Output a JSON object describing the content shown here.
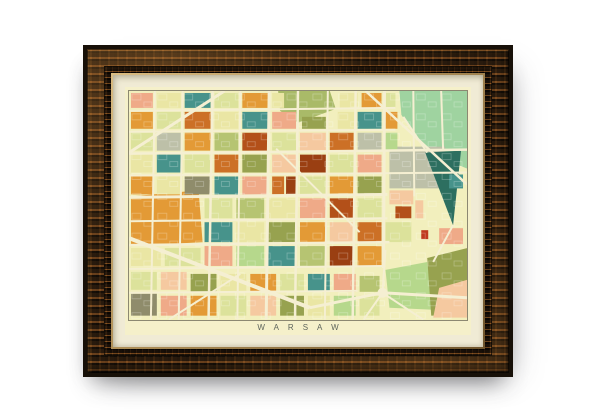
{
  "print": {
    "title": "WARSAW"
  },
  "colors": {
    "frameDark": "#171008",
    "frameMid": "#3d2a16",
    "lip": "#b3945c",
    "lipHi": "#d9bc82",
    "lipDark": "#6f552d",
    "mat": "#f0ebd5",
    "paper": "#f5f0ca",
    "rule": "#8c8872",
    "title": "#5d645c",
    "mapBase": "#f2efbd"
  },
  "map": {
    "width": 340,
    "height": 230,
    "base": "#f2efbd",
    "street_color": "#f5efd2",
    "palette": {
      "pyd": "#eae6a4",
      "yg": "#dce29b",
      "av": "#b6c472",
      "av2": "#a9ba68",
      "lg": "#b6d88c",
      "mg": "#9fd3a0",
      "ol": "#97a24f",
      "gb": "#8f8c6b",
      "te": "#47938b",
      "dt": "#2d6f60",
      "or": "#e39a36",
      "ro": "#cc7026",
      "rr": "#b35019",
      "br": "#9a3f12",
      "sa": "#efaa88",
      "pe": "#f5c9a0",
      "gr": "#bdc0a8",
      "rd": "#c03a1f"
    },
    "areas": [
      {
        "points": "272,0 340,0 340,78 300,62 274,24",
        "fill": "mg"
      },
      {
        "points": "150,0 202,0 208,18 170,32 152,20",
        "fill": "av2"
      },
      {
        "points": "262,56 318,56 318,98 262,98",
        "fill": "gr"
      },
      {
        "points": "298,62 334,60 326,135",
        "fill": "dt"
      },
      {
        "points": "2,106 70,100 74,152 2,156",
        "fill": "or"
      },
      {
        "points": "258,180 300,172 306,220 262,218",
        "fill": "lg"
      },
      {
        "points": "300,168 340,158 340,226 304,226",
        "fill": "ol"
      },
      {
        "points": "312,198 340,190 340,228 306,228",
        "fill": "pe"
      }
    ],
    "blocks": [
      [
        2,
        2,
        22,
        15,
        "sa"
      ],
      [
        28,
        2,
        24,
        15,
        "pyd"
      ],
      [
        56,
        2,
        26,
        15,
        "te"
      ],
      [
        86,
        2,
        24,
        15,
        "yg"
      ],
      [
        114,
        2,
        26,
        15,
        "or"
      ],
      [
        144,
        2,
        12,
        15,
        "pyd"
      ],
      [
        212,
        2,
        18,
        15,
        "pyd"
      ],
      [
        234,
        2,
        20,
        15,
        "or"
      ],
      [
        258,
        2,
        10,
        15,
        "yg"
      ],
      [
        2,
        21,
        22,
        17,
        "or"
      ],
      [
        28,
        21,
        24,
        17,
        "yg"
      ],
      [
        56,
        21,
        26,
        17,
        "ro"
      ],
      [
        86,
        21,
        24,
        17,
        "pyd"
      ],
      [
        114,
        21,
        26,
        17,
        "te"
      ],
      [
        144,
        21,
        24,
        17,
        "sa"
      ],
      [
        174,
        26,
        24,
        12,
        "ol"
      ],
      [
        210,
        21,
        18,
        17,
        "pyd"
      ],
      [
        230,
        21,
        24,
        17,
        "te"
      ],
      [
        258,
        21,
        12,
        17,
        "or"
      ],
      [
        2,
        42,
        22,
        18,
        "yg"
      ],
      [
        28,
        42,
        24,
        18,
        "gr"
      ],
      [
        56,
        42,
        26,
        18,
        "or"
      ],
      [
        86,
        42,
        24,
        18,
        "av"
      ],
      [
        114,
        42,
        26,
        18,
        "rr"
      ],
      [
        144,
        42,
        24,
        18,
        "yg"
      ],
      [
        172,
        42,
        26,
        18,
        "pe"
      ],
      [
        202,
        42,
        24,
        18,
        "ro"
      ],
      [
        230,
        42,
        24,
        18,
        "gr"
      ],
      [
        258,
        42,
        12,
        18,
        "lg"
      ],
      [
        2,
        64,
        22,
        18,
        "pyd"
      ],
      [
        28,
        64,
        24,
        18,
        "te"
      ],
      [
        56,
        64,
        26,
        18,
        "yg"
      ],
      [
        86,
        64,
        24,
        18,
        "ro"
      ],
      [
        114,
        64,
        26,
        18,
        "ol"
      ],
      [
        144,
        64,
        24,
        18,
        "pe"
      ],
      [
        172,
        64,
        26,
        18,
        "br"
      ],
      [
        202,
        64,
        24,
        18,
        "yg"
      ],
      [
        230,
        64,
        24,
        18,
        "sa"
      ],
      [
        322,
        84,
        14,
        14,
        "te"
      ],
      [
        2,
        86,
        22,
        18,
        "or"
      ],
      [
        28,
        86,
        24,
        18,
        "pyd"
      ],
      [
        56,
        86,
        26,
        18,
        "gb"
      ],
      [
        86,
        86,
        24,
        18,
        "te"
      ],
      [
        114,
        86,
        26,
        18,
        "sa"
      ],
      [
        144,
        86,
        12,
        18,
        "ro"
      ],
      [
        158,
        86,
        10,
        18,
        "br"
      ],
      [
        172,
        86,
        26,
        18,
        "yg"
      ],
      [
        202,
        86,
        24,
        18,
        "or"
      ],
      [
        230,
        86,
        24,
        18,
        "ol"
      ],
      [
        262,
        100,
        24,
        14,
        "pe"
      ],
      [
        268,
        116,
        16,
        12,
        "rr"
      ],
      [
        294,
        140,
        7,
        9,
        "rd"
      ],
      [
        76,
        108,
        28,
        20,
        "yg"
      ],
      [
        108,
        108,
        28,
        20,
        "av"
      ],
      [
        140,
        108,
        28,
        20,
        "pyd"
      ],
      [
        172,
        108,
        26,
        20,
        "sa"
      ],
      [
        202,
        108,
        24,
        20,
        "rr"
      ],
      [
        230,
        108,
        24,
        20,
        "yg"
      ],
      [
        288,
        110,
        8,
        18,
        "pe"
      ],
      [
        76,
        132,
        28,
        20,
        "te"
      ],
      [
        108,
        132,
        28,
        20,
        "pyd"
      ],
      [
        140,
        132,
        28,
        20,
        "ol"
      ],
      [
        172,
        132,
        26,
        20,
        "or"
      ],
      [
        202,
        132,
        24,
        20,
        "pe"
      ],
      [
        230,
        132,
        24,
        20,
        "ro"
      ],
      [
        258,
        132,
        26,
        20,
        "yg"
      ],
      [
        312,
        138,
        24,
        16,
        "sa"
      ],
      [
        2,
        158,
        30,
        18,
        "pyd"
      ],
      [
        36,
        158,
        36,
        18,
        "yg"
      ],
      [
        76,
        156,
        28,
        20,
        "sa"
      ],
      [
        108,
        156,
        28,
        20,
        "lg"
      ],
      [
        140,
        156,
        28,
        20,
        "te"
      ],
      [
        172,
        156,
        26,
        20,
        "av"
      ],
      [
        202,
        156,
        24,
        20,
        "br"
      ],
      [
        230,
        156,
        24,
        20,
        "or"
      ],
      [
        2,
        182,
        26,
        18,
        "yg"
      ],
      [
        32,
        182,
        26,
        18,
        "pe"
      ],
      [
        62,
        184,
        26,
        18,
        "ol"
      ],
      [
        92,
        184,
        26,
        18,
        "pyd"
      ],
      [
        122,
        184,
        26,
        18,
        "or"
      ],
      [
        152,
        184,
        24,
        18,
        "yg"
      ],
      [
        180,
        184,
        22,
        18,
        "te"
      ],
      [
        206,
        184,
        22,
        18,
        "sa"
      ],
      [
        232,
        186,
        20,
        16,
        "av"
      ],
      [
        2,
        204,
        26,
        22,
        "gb"
      ],
      [
        32,
        206,
        26,
        20,
        "sa"
      ],
      [
        62,
        206,
        26,
        20,
        "or"
      ],
      [
        92,
        206,
        26,
        20,
        "yg"
      ],
      [
        122,
        206,
        26,
        20,
        "pe"
      ],
      [
        152,
        206,
        24,
        20,
        "ol"
      ],
      [
        180,
        206,
        22,
        20,
        "pyd"
      ],
      [
        206,
        206,
        22,
        20,
        "lg"
      ],
      [
        232,
        206,
        20,
        20,
        "yg"
      ]
    ],
    "streets": [
      [
        0,
        20,
        268,
        17,
        2
      ],
      [
        0,
        41,
        268,
        39,
        2
      ],
      [
        0,
        63,
        340,
        59,
        2.5
      ],
      [
        0,
        85,
        340,
        82,
        2
      ],
      [
        0,
        107,
        260,
        104,
        3
      ],
      [
        0,
        131,
        260,
        128,
        2
      ],
      [
        0,
        155,
        262,
        152,
        2.5
      ],
      [
        0,
        179,
        258,
        176,
        2
      ],
      [
        0,
        203,
        230,
        201,
        2
      ],
      [
        26,
        0,
        22,
        230,
        2
      ],
      [
        54,
        0,
        50,
        230,
        2
      ],
      [
        84,
        0,
        80,
        230,
        2.5
      ],
      [
        112,
        0,
        109,
        230,
        2
      ],
      [
        141,
        0,
        138,
        230,
        3
      ],
      [
        170,
        0,
        167,
        230,
        2.5
      ],
      [
        200,
        0,
        197,
        230,
        2
      ],
      [
        228,
        0,
        225,
        230,
        2.5
      ],
      [
        257,
        0,
        256,
        178,
        3
      ],
      [
        286,
        0,
        287,
        106,
        2
      ],
      [
        314,
        0,
        316,
        60,
        2
      ],
      [
        96,
        0,
        0,
        62,
        3
      ],
      [
        238,
        0,
        340,
        94,
        2.5
      ],
      [
        148,
        58,
        232,
        142,
        2
      ],
      [
        0,
        148,
        182,
        218,
        4
      ],
      [
        182,
        218,
        255,
        203,
        3
      ],
      [
        255,
        203,
        340,
        208,
        3
      ],
      [
        255,
        203,
        236,
        230,
        2
      ],
      [
        255,
        203,
        296,
        230,
        2
      ],
      [
        255,
        203,
        258,
        160,
        2
      ],
      [
        40,
        230,
        112,
        184,
        2
      ],
      [
        300,
        62,
        276,
        26,
        2
      ],
      [
        326,
        135,
        306,
        172,
        2
      ]
    ],
    "circles": [
      [
        255,
        203,
        5
      ]
    ],
    "texture": {
      "tile": [
        26,
        20
      ],
      "boxes": [
        [
          3,
          3,
          9,
          6
        ],
        [
          15,
          11,
          8,
          5
        ]
      ],
      "stroke": "#ffffff",
      "opacity": 0.28
    }
  }
}
